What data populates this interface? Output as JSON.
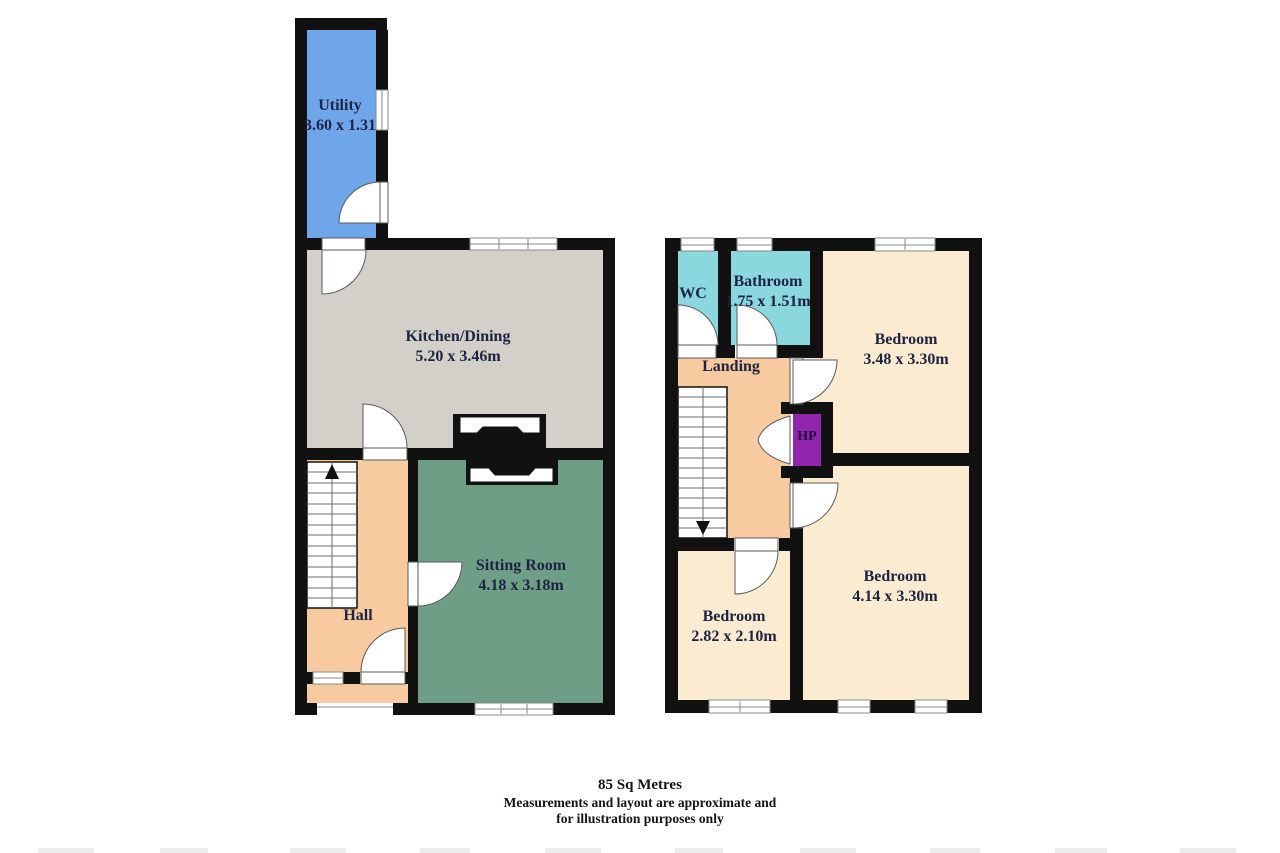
{
  "plan": {
    "type": "floorplan",
    "rooms": {
      "utility": {
        "name": "Utility",
        "dims": "3.60 x 1.31"
      },
      "kitchen": {
        "name": "Kitchen/Dining",
        "dims": "5.20 x 3.46m"
      },
      "hall": {
        "name": "Hall"
      },
      "sitting": {
        "name": "Sitting Room",
        "dims": "4.18 x 3.18m"
      },
      "wc": {
        "name": "WC"
      },
      "bathroom": {
        "name": "Bathroom",
        "dims": "1.75 x 1.51m"
      },
      "bedroom_front": {
        "name": "Bedroom",
        "dims": "3.48 x 3.30m"
      },
      "landing": {
        "name": "Landing"
      },
      "hot_press": {
        "name": "HP"
      },
      "bedroom_small": {
        "name": "Bedroom",
        "dims": "2.82 x 2.10m"
      },
      "bedroom_back": {
        "name": "Bedroom",
        "dims": "4.14 x 3.30m"
      }
    },
    "footer": {
      "area": "85 Sq Metres",
      "disclaimer_line1": "Measurements and layout are approximate and",
      "disclaimer_line2": "for illustration purposes only"
    },
    "colors": {
      "wall": "#111111",
      "utility": "#6FA6E9",
      "kitchen": "#D3D0C9",
      "hall_landing": "#F7CA9F",
      "sitting": "#6F9E87",
      "wc_bathroom": "#8AD8DD",
      "bedroom": "#FAEBD1",
      "hot_press": "#9326AE",
      "label_text": "#1D2342"
    }
  }
}
